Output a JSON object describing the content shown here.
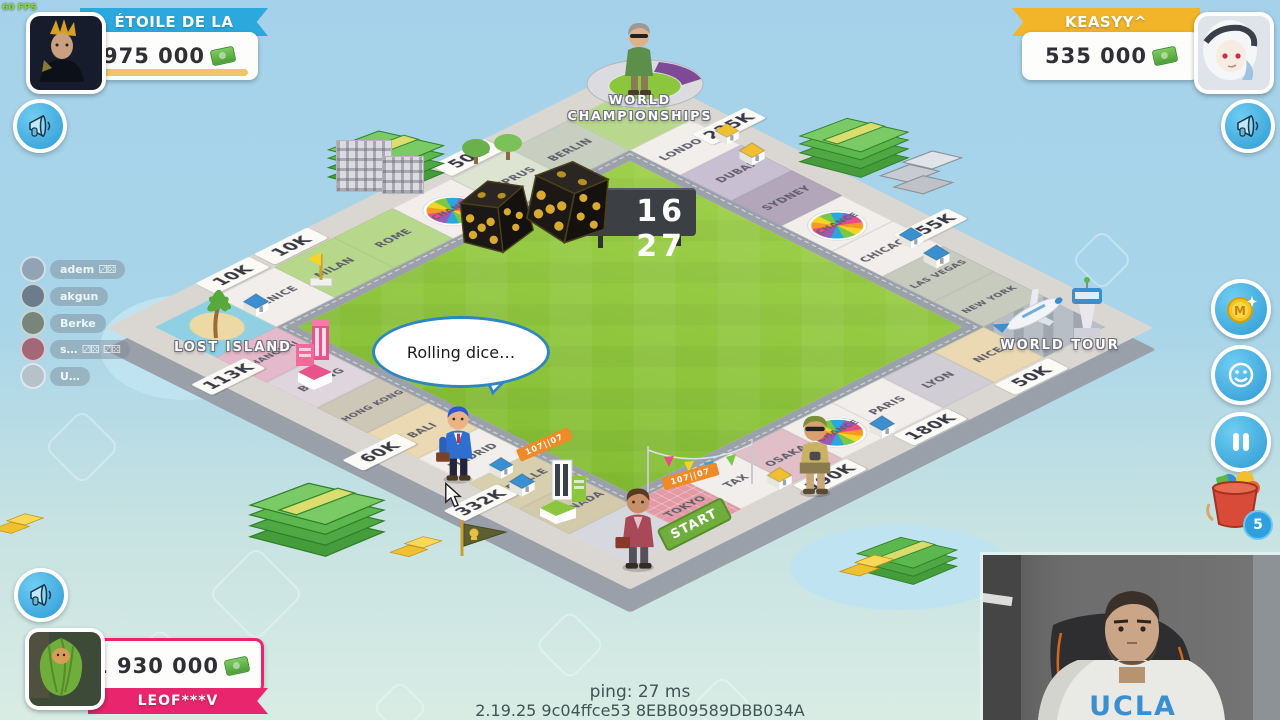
{
  "hud": {
    "fps": "60 FPS",
    "ping": "ping: 27 ms",
    "build": "2.19.25 9c04ffce53 8EBB09589DBB034A"
  },
  "players": {
    "left": {
      "name": "ÉTOILE DE LA",
      "money": "975 000",
      "accent": "#2ba9de"
    },
    "right": {
      "name": "KEASYY^",
      "money": "535 000",
      "accent": "#f2b428"
    },
    "bottom": {
      "name": "LEOF***V",
      "money": "1 930 000",
      "accent": "#e9256e"
    }
  },
  "spectators": {
    "items": [
      {
        "name": "adem"
      },
      {
        "name": "akgun"
      },
      {
        "name": "Berke"
      },
      {
        "name": "s…"
      },
      {
        "name": "U…"
      }
    ]
  },
  "icons": {
    "dice_pair": "⚂⚄"
  },
  "actions": {
    "bucket_badge": "5"
  },
  "board": {
    "timer": "16 27",
    "bubble": "Rolling dice…",
    "banner": "107||07",
    "start_label": "START",
    "corner_top": "WORLD CHAMPIONSHIPS",
    "corner_right": "WORLD TOUR",
    "corner_left": "LOST ISLAND",
    "ne": [
      {
        "name": "LONDON",
        "price": "225K"
      },
      {
        "name": "DUBAI"
      },
      {
        "name": "SYDNEY"
      },
      {
        "name": "CHANCE"
      },
      {
        "name": "CHICAGO",
        "price": "255K"
      },
      {
        "name": "LAS VEGAS"
      },
      {
        "name": "NEW YORK"
      }
    ],
    "se": [
      {
        "name": "NICE",
        "price": "50K"
      },
      {
        "name": "LYON"
      },
      {
        "name": "PARIS",
        "price": "180K"
      },
      {
        "name": "CHANCE"
      },
      {
        "name": "OSAKA",
        "price": "190K"
      },
      {
        "name": "TAX"
      },
      {
        "name": "TOKYO"
      }
    ],
    "sw": [
      {
        "name": "GRANADA"
      },
      {
        "name": "SEVILLE",
        "price": "332K"
      },
      {
        "name": "MADRID"
      },
      {
        "name": "BALI",
        "price": "60K"
      },
      {
        "name": "HONG KONG"
      },
      {
        "name": "BEIJING"
      },
      {
        "name": "SHANGHAI",
        "price": "113K"
      }
    ],
    "nw": [
      {
        "name": "VENICE",
        "price": "10K"
      },
      {
        "name": "MILAN",
        "price": "10K"
      },
      {
        "name": "ROME"
      },
      {
        "name": "CHANCE"
      },
      {
        "name": "CYPRUS",
        "price": "50K"
      },
      {
        "name": "BERLIN"
      }
    ]
  }
}
